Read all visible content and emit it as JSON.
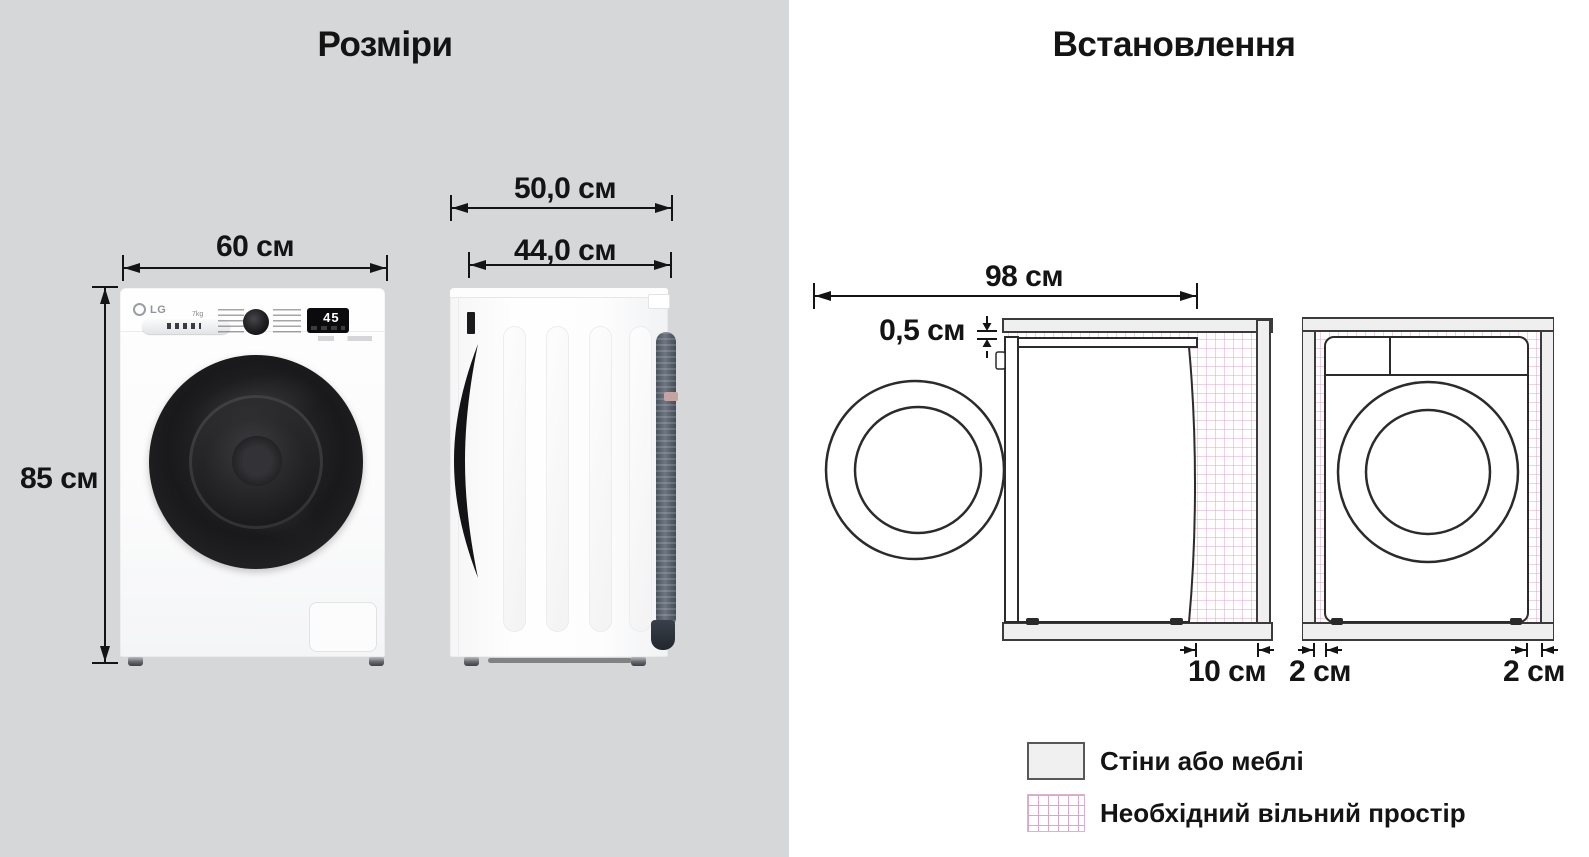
{
  "dimensions": {
    "title": "Розміри",
    "front": {
      "width": "60 см",
      "height": "85 см",
      "brand": "LG",
      "capacity": "7kg",
      "display_value": "45"
    },
    "side": {
      "depth_with_door": "50,0 см",
      "depth_body": "44,0 см"
    }
  },
  "installation": {
    "title": "Встановлення",
    "side_view": {
      "depth_total": "98 см",
      "top_clearance": "0,5 см",
      "rear_clearance": "10 см"
    },
    "front_view": {
      "left_clearance": "2 см",
      "right_clearance": "2 см"
    },
    "legend": {
      "walls": "Стіни або меблі",
      "free_space": "Необхідний вільний простір"
    }
  },
  "colors": {
    "left_background": "#d5d7d8",
    "right_background": "#ffffff",
    "wall_fill": "#efefef",
    "outline": "#2b2b2b",
    "free_space_grid": "#d8a8c6",
    "door_black": "#1a1a1c",
    "hose_gray": "#5b6470"
  }
}
